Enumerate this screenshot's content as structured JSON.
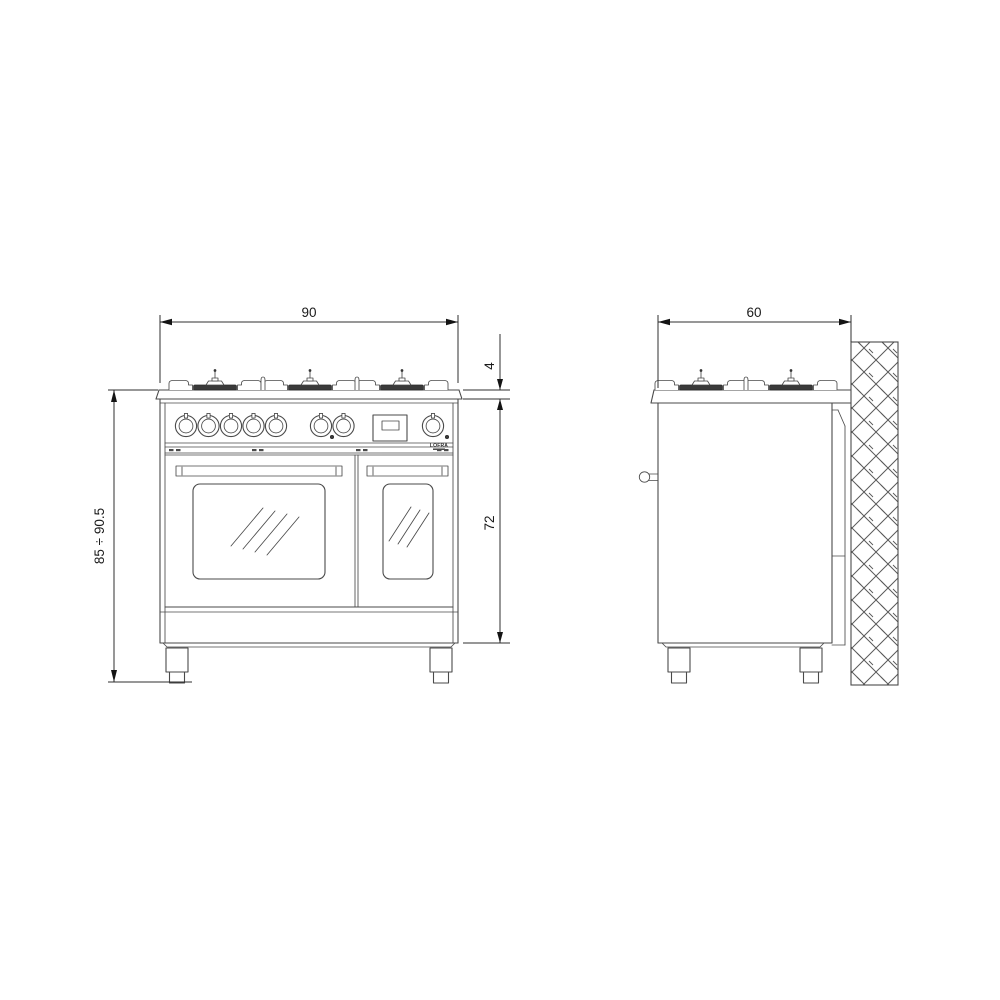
{
  "diagram": {
    "brand_logo": "LOFRA",
    "dimensions": {
      "front_width": "90",
      "side_depth": "60",
      "hob_thickness": "4",
      "body_height": "72",
      "total_height": "85 ÷ 90.5"
    },
    "colors": {
      "line": "#4a4a4a",
      "dimension_text": "#1a1a1a",
      "background": "#ffffff"
    }
  }
}
